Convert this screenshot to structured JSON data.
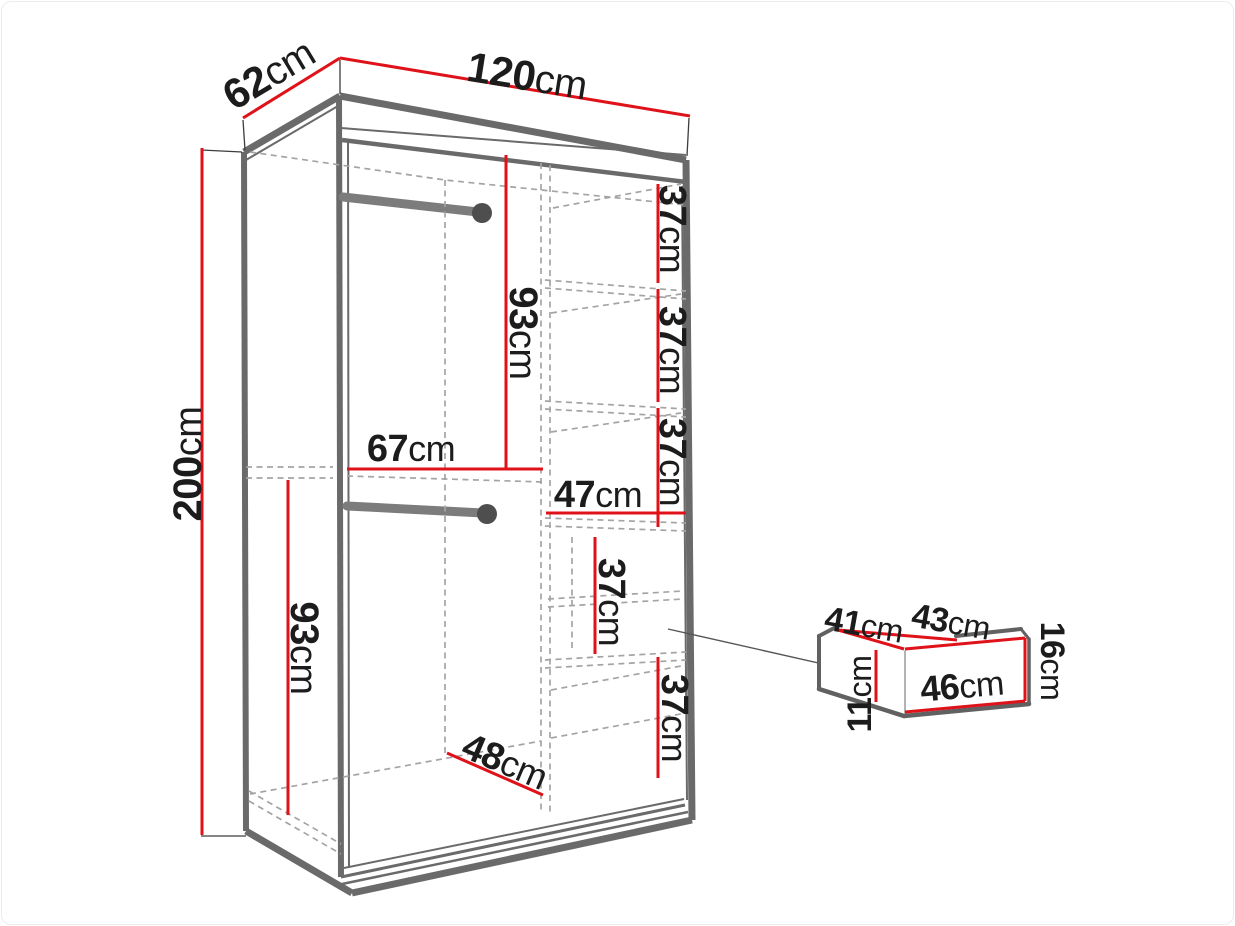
{
  "diagram": {
    "type": "furniture dimension diagram",
    "subject": "sliding-door wardrobe, open-front perspective view with interior layout and pull-out drawer detail",
    "unit": "cm",
    "colors": {
      "dimension_line": "#e01219",
      "body_line": "#6a6a6a",
      "hidden_line": "#a4a4a4",
      "text": "#1c1c1c"
    },
    "labels": {
      "width": "120cm",
      "depth": "62cm",
      "height": "200cm",
      "upper_hanging_height": "93cm",
      "lower_hanging_height": "93cm",
      "hanging_section_width": "67cm",
      "shelf_column_width": "47cm",
      "shelf_gap_1": "37cm",
      "shelf_gap_2": "37cm",
      "shelf_gap_3": "37cm",
      "drawer_bay_height": "37cm",
      "bottom_section_height": "37cm",
      "interior_depth": "48cm"
    },
    "drawer_detail": {
      "outer_depth": "41cm",
      "outer_width": "43cm",
      "front_height": "16cm",
      "inner_height": "11cm",
      "inner_width": "46cm"
    }
  }
}
